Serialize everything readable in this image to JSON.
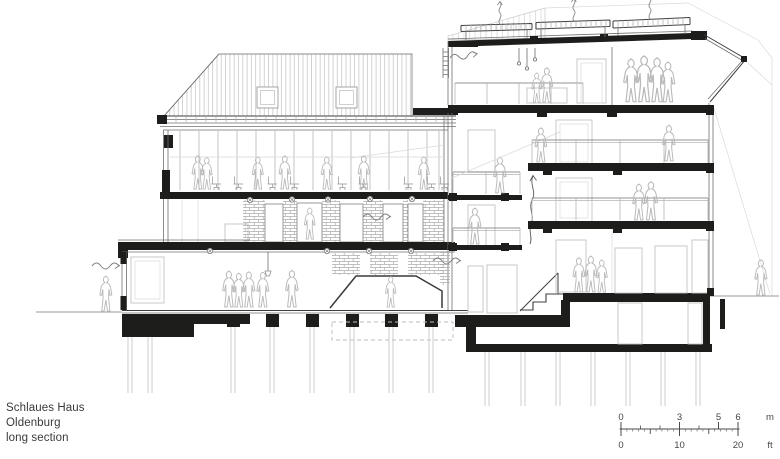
{
  "caption": {
    "line1": "Schlaues Haus",
    "line2": "Oldenburg",
    "line3": "long section"
  },
  "scale_bar": {
    "meters": {
      "ticks": [
        "0",
        "3",
        "5",
        "6"
      ],
      "unit": "m"
    },
    "feet": {
      "ticks": [
        "0",
        "10",
        "20"
      ],
      "unit": "ft"
    }
  },
  "colors": {
    "cut_line": "#1d1d1b",
    "medium_line": "#6f6f6f",
    "light_line": "#b5b5b5",
    "background": "#ffffff"
  }
}
